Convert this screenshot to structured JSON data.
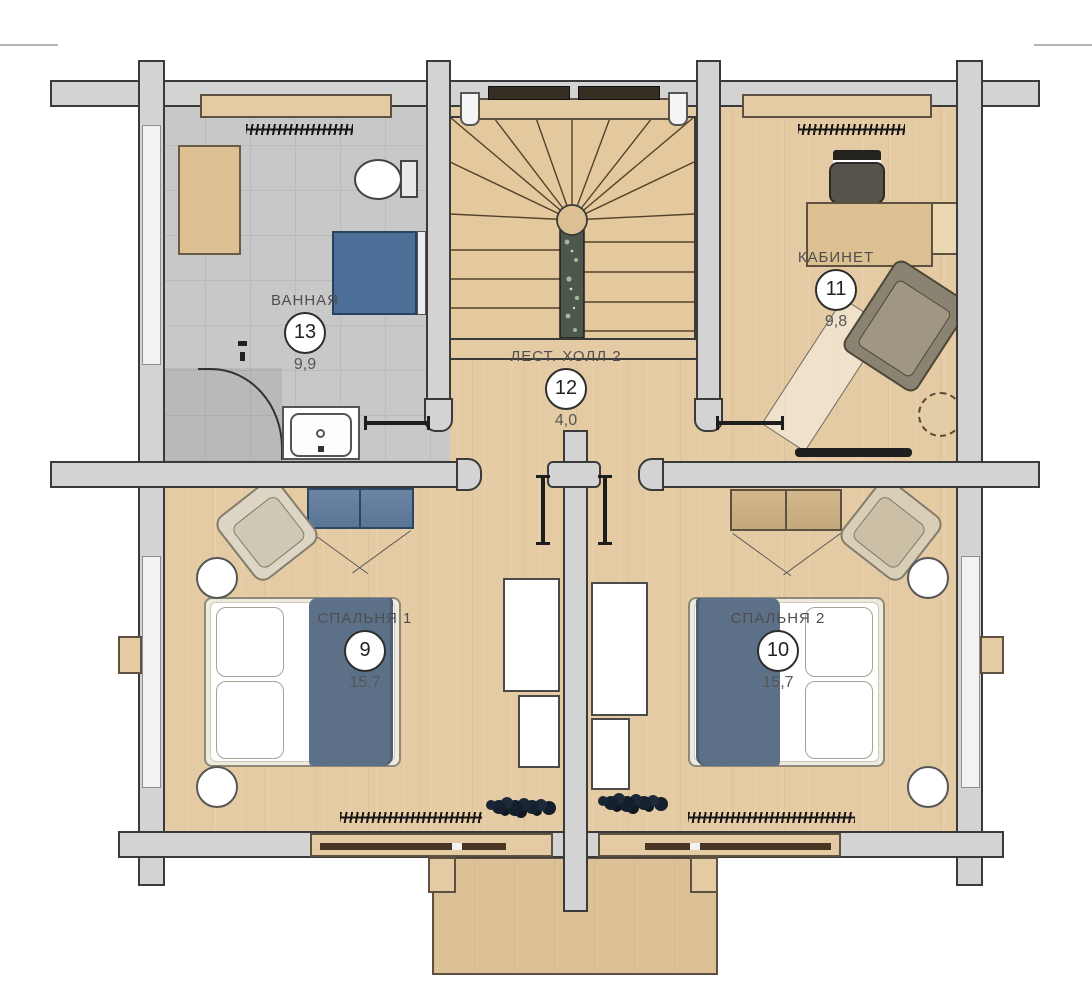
{
  "rooms": {
    "bathroom": {
      "label": "ВАННАЯ",
      "number": "13",
      "area": "9,9"
    },
    "office": {
      "label": "КАБИНЕТ",
      "number": "11",
      "area": "9,8"
    },
    "stair_hall": {
      "label": "ЛЕСТ. ХОЛЛ 2",
      "number": "12",
      "area": "4,0"
    },
    "bedroom1": {
      "label": "СПАЛЬНЯ 1",
      "number": "9",
      "area": "15,7"
    },
    "bedroom2": {
      "label": "СПАЛЬНЯ 2",
      "number": "10",
      "area": "15,7"
    }
  },
  "colors": {
    "wood": "#e5cba3",
    "tile": "#c8c8c8",
    "wall": "#d3d3d3",
    "outline": "#3a3a3a",
    "blue": "#5c7188",
    "tub_blue": "#4c6f97",
    "dresser_blue": "#5a7697",
    "text": "#4e4e4e"
  }
}
